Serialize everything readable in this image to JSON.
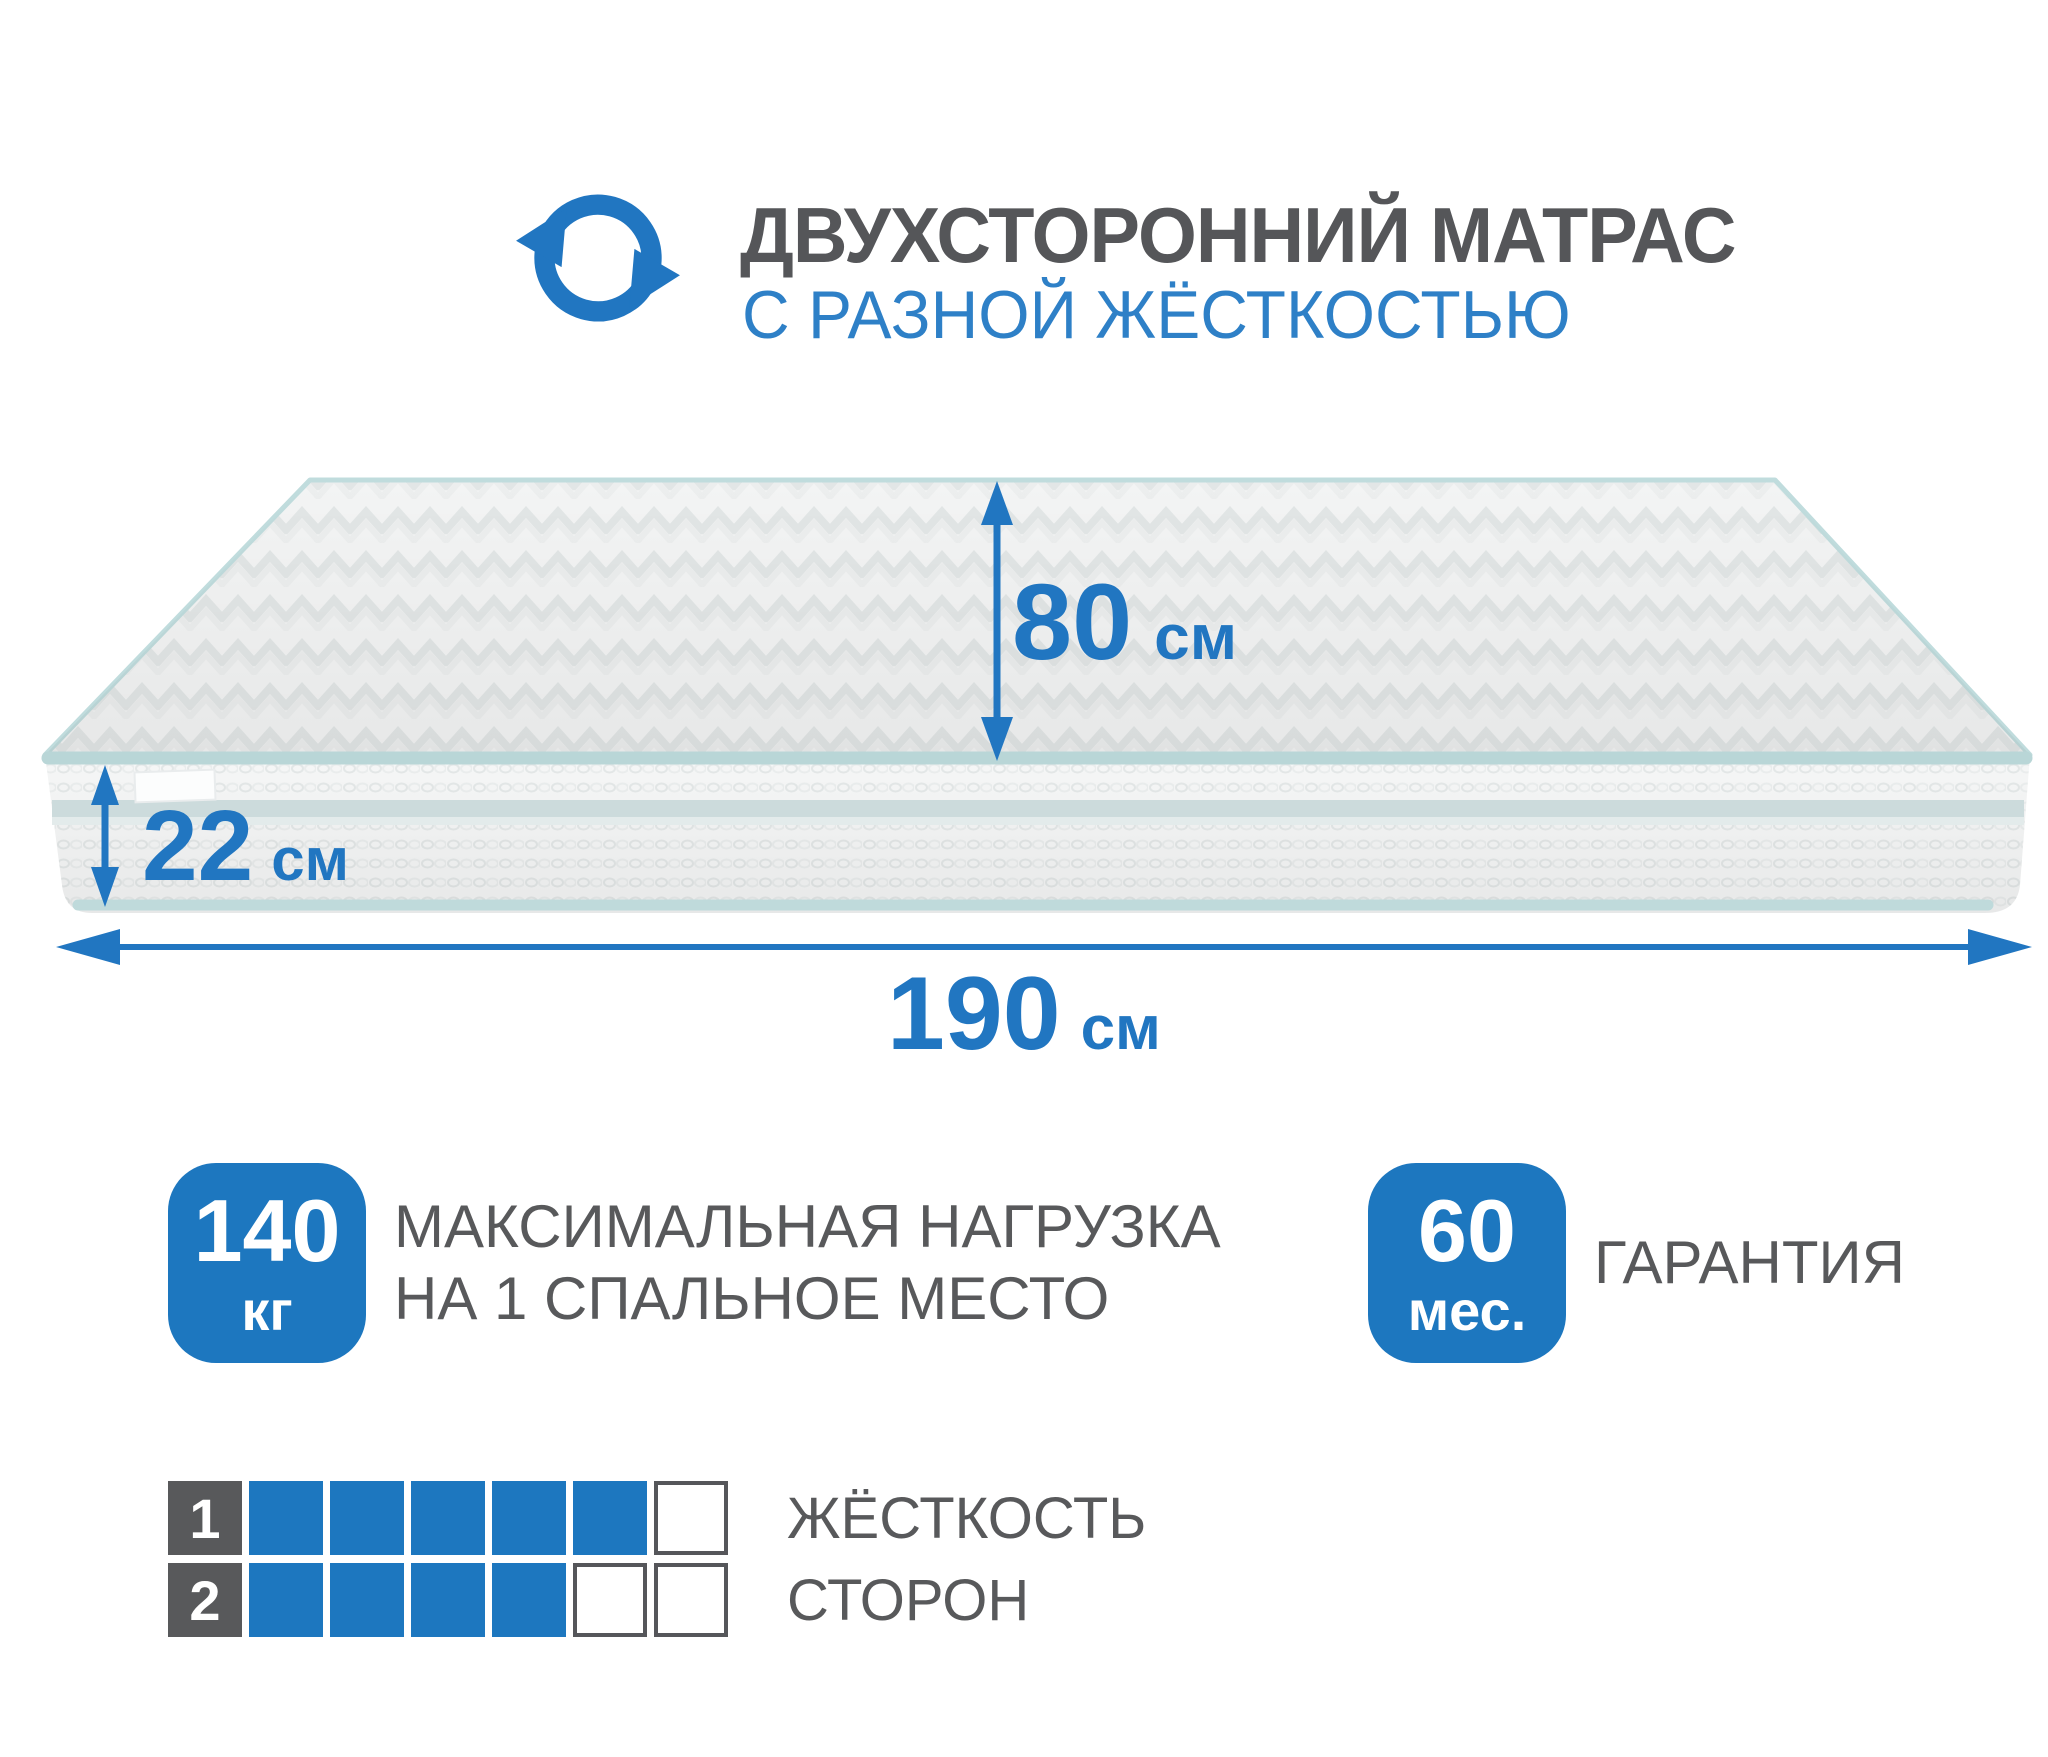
{
  "header": {
    "icon": "double-rotation-arrows",
    "title": "ДВУХСТОРОННИЙ МАТРАС",
    "subtitle": "С РАЗНОЙ ЖЁСТКОСТЬЮ"
  },
  "colors": {
    "accent_blue": "#1d77bf",
    "arrow_blue": "#2176c1",
    "subtitle_blue": "#2e80c7",
    "text_gray": "#58595b",
    "title_gray": "#555659",
    "piping_mint": "#b9d6d7",
    "fabric_white": "#f4f5f5"
  },
  "mattress": {
    "depth_label": {
      "value": "80",
      "unit": "см"
    },
    "thickness_label": {
      "value": "22",
      "unit": "см"
    },
    "length_label": {
      "value": "190",
      "unit": "см"
    }
  },
  "features": {
    "max_load": {
      "value": "140",
      "unit": "кг",
      "label_line1": "МАКСИМАЛЬНАЯ НАГРУЗКА",
      "label_line2": "НА 1 СПАЛЬНОЕ МЕСТО"
    },
    "warranty": {
      "value": "60",
      "unit": "мес.",
      "label": "ГАРАНТИЯ"
    }
  },
  "firmness": {
    "label_line1": "ЖЁСТКОСТЬ",
    "label_line2": "СТОРОН",
    "rows": [
      {
        "number": "1",
        "filled": 5,
        "total": 6
      },
      {
        "number": "2",
        "filled": 4,
        "total": 6
      }
    ]
  }
}
